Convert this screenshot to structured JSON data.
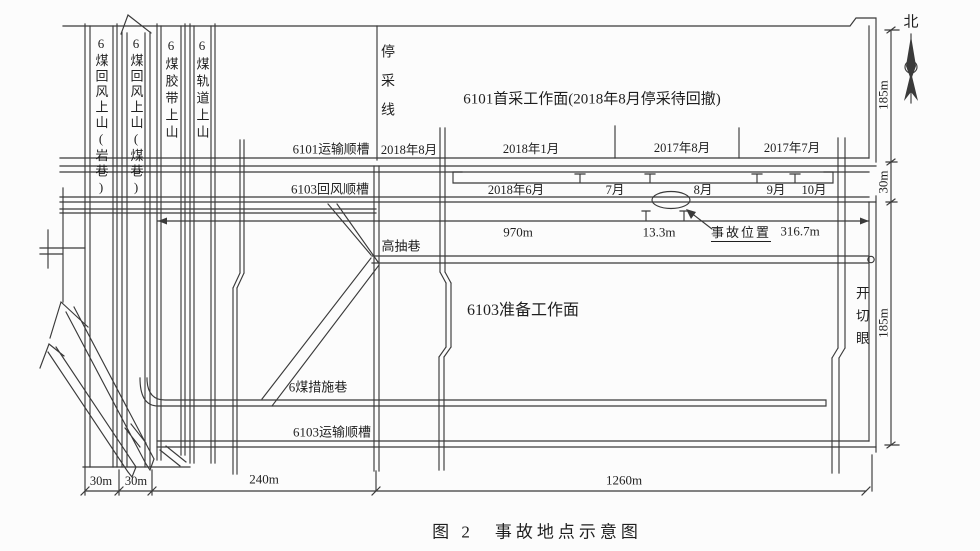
{
  "page": {
    "background": "#fcfcfc",
    "line_color": "#3a3a3a",
    "text_color": "#1f1f1f"
  },
  "caption": "图 2　事故地点示意图",
  "compass": {
    "north": "北"
  },
  "panel_6101": {
    "face": "6101首采工作面(2018年8月停采待回撤)",
    "stop_line": "停采线",
    "transport": "6101运输顺槽",
    "date_2018_08": "2018年8月",
    "date_2018_01": "2018年1月",
    "date_2017_08": "2017年8月",
    "date_2017_07": "2017年7月"
  },
  "panel_6103": {
    "return_roadway": "6103回风顺槽",
    "month_2018_06": "2018年6月",
    "month_07": "7月",
    "month_08": "8月",
    "month_09": "9月",
    "month_10": "10月",
    "high_drainage": "高抽巷",
    "face": "6103准备工作面",
    "measure_roadway": "6煤措施巷",
    "transport": "6103运输顺槽",
    "cut_hole": "开切眼"
  },
  "uphills": [
    "6煤回风上山(岩巷)",
    "6煤回风上山(煤巷)",
    "6煤胶带上山",
    "6煤轨道上山"
  ],
  "accident": {
    "label": "事故位置"
  },
  "dims": {
    "w970": "970m",
    "w13_3": "13.3m",
    "w316_7": "316.7m",
    "h185_top": "185m",
    "h30_right": "30m",
    "h185_bottom": "185m",
    "b30_1": "30m",
    "b30_2": "30m",
    "b240": "240m",
    "b1260": "1260m"
  }
}
